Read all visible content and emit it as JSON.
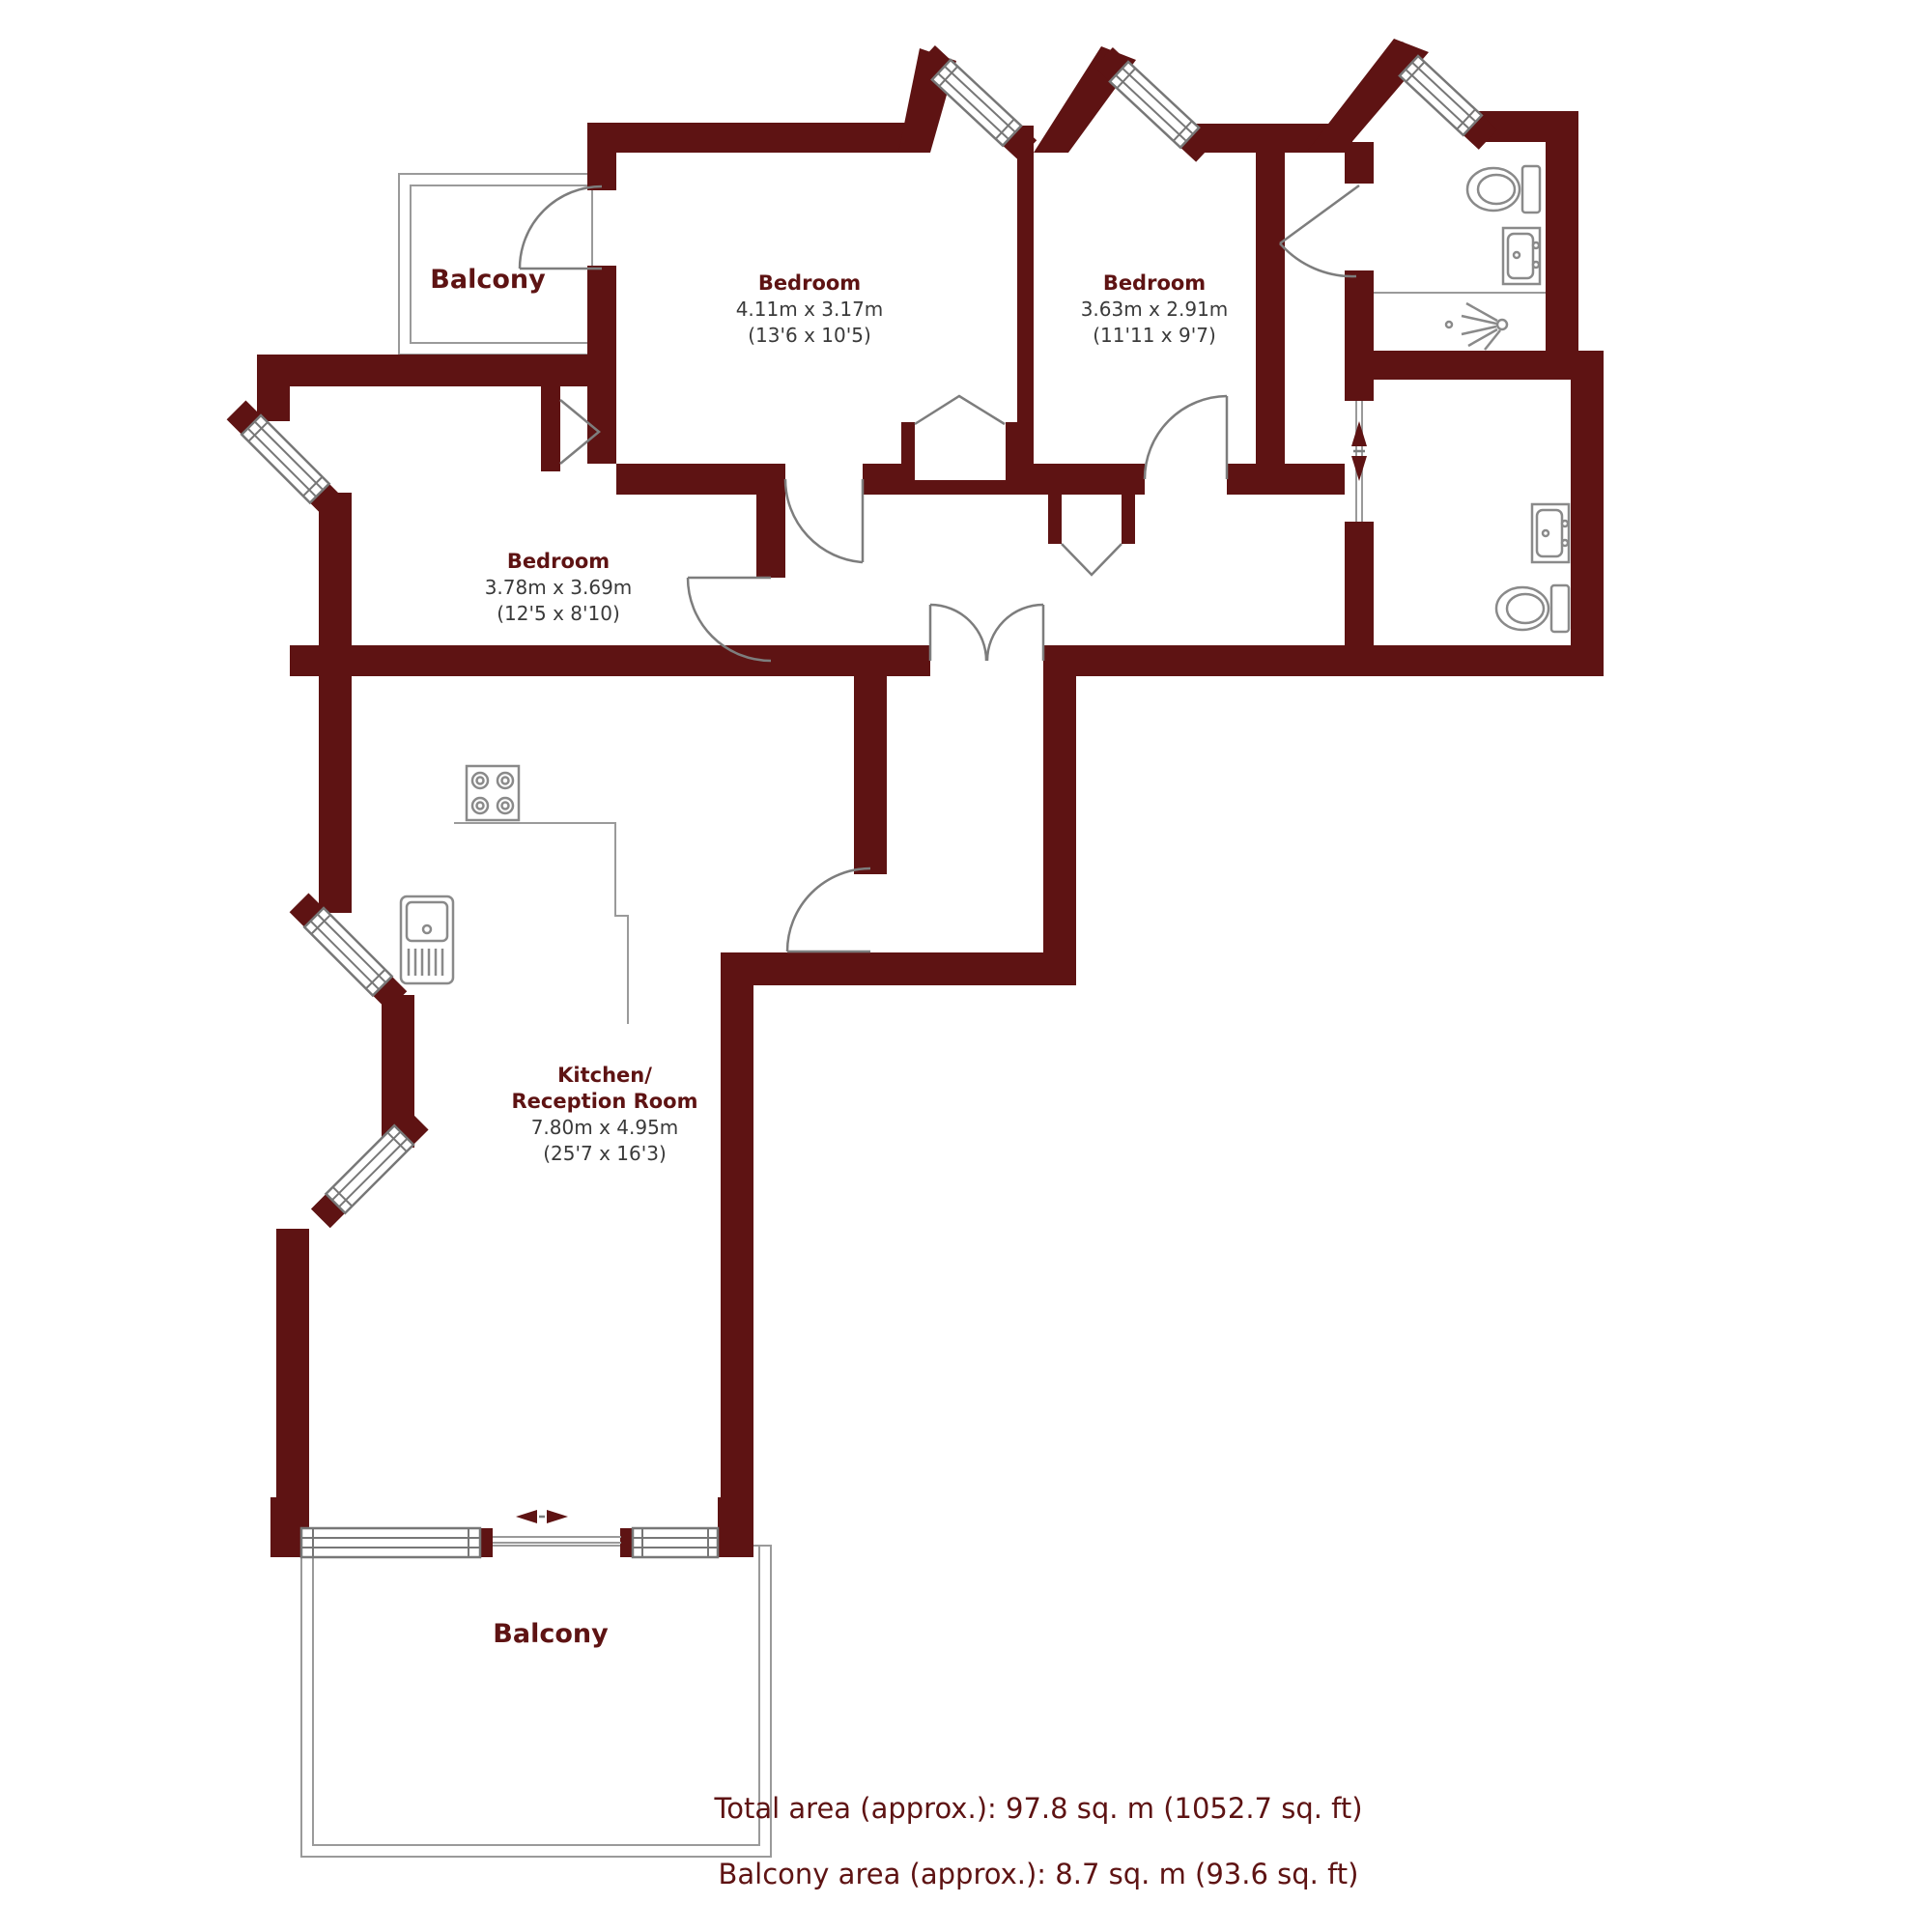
{
  "plan": {
    "colors": {
      "wall": "#5e1313",
      "fixture_line": "#8a8a8a",
      "balcony_outline": "#9a9a9a",
      "dim_text": "#3a3a3a"
    },
    "rooms": [
      {
        "name": "Bedroom",
        "dim_m": "4.11m x 3.17m",
        "dim_ft": "(13'6 x 10'5)"
      },
      {
        "name": "Bedroom",
        "dim_m": "3.63m x 2.91m",
        "dim_ft": "(11'11 x 9'7)"
      },
      {
        "name": "Bedroom",
        "dim_m": "3.78m x 3.69m",
        "dim_ft": "(12'5 x 8'10)"
      },
      {
        "name_line1": "Kitchen/",
        "name_line2": "Reception Room",
        "dim_m": "7.80m x 4.95m",
        "dim_ft": "(25'7 x 16'3)"
      }
    ],
    "balconies": [
      {
        "label": "Balcony"
      },
      {
        "label": "Balcony"
      }
    ],
    "fixtures": [
      "toilet",
      "basin",
      "shower-head",
      "toilet",
      "basin",
      "hob",
      "kitchen-sink",
      "sliding-door",
      "sliding-door"
    ],
    "summary": {
      "total": "Total area (approx.): 97.8 sq. m (1052.7 sq. ft)",
      "balcony": "Balcony area (approx.): 8.7 sq. m (93.6 sq. ft)"
    }
  }
}
